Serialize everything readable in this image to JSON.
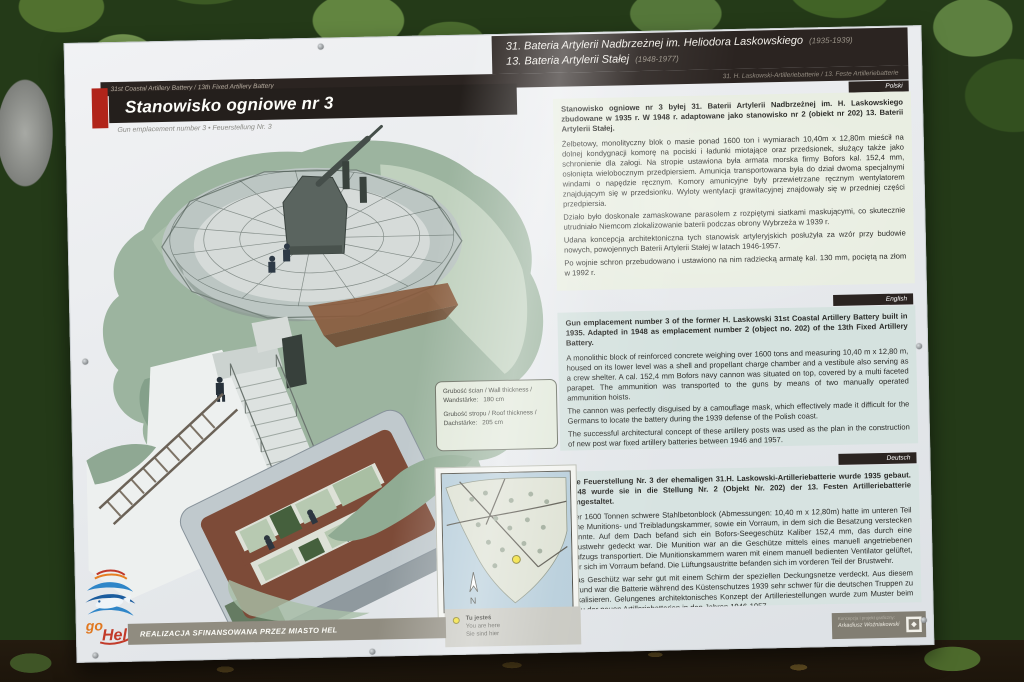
{
  "header": {
    "title": "Stanowisko ogniowe nr 3",
    "subtitle": "Gun emplacement number 3  •  Feuerstellung Nr. 3",
    "battery_pl_1": "31. Bateria Artylerii Nadbrzeżnej im. Heliodora Laskowskiego",
    "battery_pl_1_years": "(1935-1939)",
    "battery_pl_2": "13. Bateria Artylerii Stałej",
    "battery_pl_2_years": "(1948-1977)",
    "battery_en": "31st Coastal Artillery Battery / 13th Fixed Artillery Battery",
    "battery_de": "31. H. Laskowski-Artilleriebatterie / 13. Feste Artilleriebatterie"
  },
  "sections": {
    "polish": {
      "tag": "Polski",
      "intro": "Stanowisko ogniowe nr 3 byłej 31. Baterii Artylerii Nadbrzeżnej im. H. Laskowskiego zbudowane w 1935 r. W 1948 r. adaptowane jako stanowisko nr 2 (obiekt nr 202) 13. Baterii Artylerii Stałej.",
      "paragraphs": [
        "Żelbetowy, monolityczny blok o masie ponad 1600 ton i wymiarach 10,40m x 12,80m mieścił na dolnej kondygnacji komorę na pociski i ładunki miotające oraz przedsionek, służący także jako schronienie dla załogi. Na stropie ustawiona była armata morska firmy Bofors kal. 152,4 mm, osłonięta wielobocznym przedpiersiem. Amunicja transportowana była do dział dwoma specjalnymi windami o napędzie ręcznym. Komory amunicyjne były przewietrzane ręcznym wentylatorem znajdującym się w przedsionku. Wyloty wentylacji grawitacyjnej znajdowały się w przedniej części przedpiersia.",
        "Działo było doskonale zamaskowane parasolem z rozpiętymi siatkami maskującymi, co skutecznie utrudniało Niemcom zlokalizowanie baterii podczas obrony Wybrzeża w 1939 r.",
        "Udana koncepcja architektoniczna tych stanowisk artyleryjskich posłużyła za wzór przy budowie nowych, powojennych Baterii Artylerii Stałej w latach 1946-1957.",
        "Po wojnie schron przebudowano i ustawiono na nim radziecką armatę kal. 130 mm, pociętą na złom w 1992 r."
      ]
    },
    "english": {
      "tag": "English",
      "intro": "Gun emplacement number 3 of the former H. Laskowski 31st Coastal Artillery Battery built in 1935. Adapted in 1948 as emplacement number 2 (object no. 202) of the 13th Fixed Artillery Battery.",
      "paragraphs": [
        "A monolithic block of reinforced concrete weighing over 1600 tons and measuring 10,40 m x 12,80 m, housed on its lower level was a shell and propellant charge chamber and a vestibule also serving as a crew shelter. A cal. 152,4 mm Bofors navy cannon was situated on top, covered by a multi faceted parapet. The ammunition was transported to the guns by means of two manually operated ammunition hoists.",
        "The cannon was perfectly disguised by a camouflage mask, which effectively made it difficult for the Germans to locate the battery during the 1939 defense of the Polish coast.",
        "The successful architectural concept of these artillery posts was used as the plan in the construction of new post war fixed artillery batteries between 1946 and 1957.",
        "After the war the shelter was restructured and fitted with a Soviet cal. 130 mm cannon, which was scrapped in 1992."
      ]
    },
    "german": {
      "tag": "Deutsch",
      "intro": "Die Feuerstellung Nr. 3 der ehemaligen 31.H. Laskowski-Artilleriebatterie wurde 1935 gebaut. 1948 wurde sie in die Stellung Nr. 2 (Objekt Nr. 202) der 13. Festen Artilleriebatterie umgestaltet.",
      "paragraphs": [
        "Der 1600 Tonnen schwere Stahlbetonblock (Abmessungen: 10,40 m x 12,80m) hatte im unteren Teil eine Munitions- und Treibladungskammer, sowie ein Vorraum, in dem sich die Besatzung verstecken konnte. Auf dem Dach befand sich ein Bofors-Seegeschütz Kaliber 152,4 mm, das durch eine Brustwehr gedeckt war. Die Munition war an die Geschütze mittels eines manuell angetriebenen Aufzugs transportiert. Die Munitionskammern waren mit einem manuell bedienten Ventilator gelüftet, der sich im Vorraum befand. Die Lüftungsaustritte befanden sich im vorderen Teil der Brustwehr.",
        "Das Geschütz war sehr gut mit einem Schirm der speziellen Deckungsnetze verdeckt. Aus diesem Grund war die Batterie während des Küstenschutzes 1939 sehr schwer für die deutschen Truppen zu lokalisieren. Gelungenes architektonisches Konzept der Artilleriestellungen wurde zum Muster beim Bau der neuen Artilleriebatterien in den Jahren 1946-1957.",
        "Nach dem Krieg wurde der Bunker umgebaut. Auf dem Bunker stand dann das sowjetische Geschütz 130 mm, das 1992 verschrottet wurde."
      ]
    }
  },
  "diagram_labels": {
    "wall": "Grubość ścian / Wall thickness / Wandstärke:",
    "wall_value": "180 cm",
    "roof": "Grubość stropu / Roof thickness / Dachstärke:",
    "roof_value": "205 cm"
  },
  "map": {
    "north": "N",
    "legend": {
      "pl": "Tu jesteś",
      "en": "You are here",
      "de": "Sie sind hier"
    }
  },
  "footer": {
    "funding": "REALIZACJA SFINANSOWANA PRZEZ MIASTO HEL",
    "credits_label": "Koncepcja i projekt graficzny:",
    "credits_name": "Arkadiusz Woźniakowski",
    "logo_go": "go",
    "logo_hel": "Hel"
  },
  "colors": {
    "accent_red": "#b1241a",
    "bar_dark": "#2b2421",
    "camo_green": "#9cb49f",
    "cutaway_brown": "#7d4b38",
    "legend_yellow": "#f2de2a",
    "funding_gray": "#908c80"
  }
}
